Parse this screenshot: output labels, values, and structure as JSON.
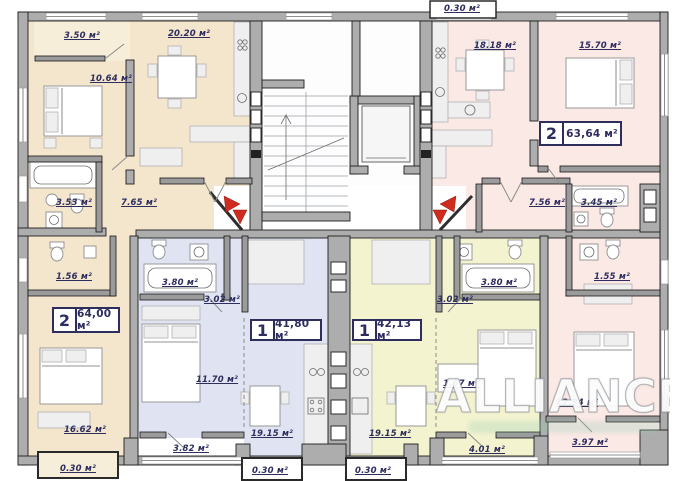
{
  "colors": {
    "wall": "#adadad",
    "beige": "#f4e6cd",
    "pink": "#fbe9e6",
    "blue": "#e0e4f2",
    "yellow": "#f3f3d0",
    "arrow_red": "#cf2c1f",
    "label_ink": "#2d2d5e"
  },
  "watermark": {
    "text": "ALLIANCE"
  },
  "apartment_badges": [
    {
      "rooms": "2",
      "area": "64,00 м²"
    },
    {
      "rooms": "2",
      "area": "63,64 м²"
    },
    {
      "rooms": "1",
      "area": "41,80 м²"
    },
    {
      "rooms": "1",
      "area": "42,13 м²"
    }
  ],
  "room_labels": [
    {
      "text": "3.50 м²"
    },
    {
      "text": "20.20 м²"
    },
    {
      "text": "0.30 м²"
    },
    {
      "text": "18.18 м²"
    },
    {
      "text": "15.70 м²"
    },
    {
      "text": "10.64 м²"
    },
    {
      "text": "3.53 м²"
    },
    {
      "text": "7.65 м²"
    },
    {
      "text": "7.56 м²"
    },
    {
      "text": "3.45 м²"
    },
    {
      "text": "1.56 м²"
    },
    {
      "text": "3.80 м²"
    },
    {
      "text": "3.02 м²"
    },
    {
      "text": "3.02 м²"
    },
    {
      "text": "3.80 м²"
    },
    {
      "text": "1.55 м²"
    },
    {
      "text": "11.70 м²"
    },
    {
      "text": "1.67 м²"
    },
    {
      "text": "12.94 м²"
    },
    {
      "text": "16.62 м²"
    },
    {
      "text": "19.15 м²"
    },
    {
      "text": "19.15 м²"
    },
    {
      "text": "3.82 м²"
    },
    {
      "text": "4.01 м²"
    },
    {
      "text": "3.97 м²"
    },
    {
      "text": "0.30 м²"
    },
    {
      "text": "0.30 м²"
    },
    {
      "text": "0.30 м²"
    }
  ]
}
